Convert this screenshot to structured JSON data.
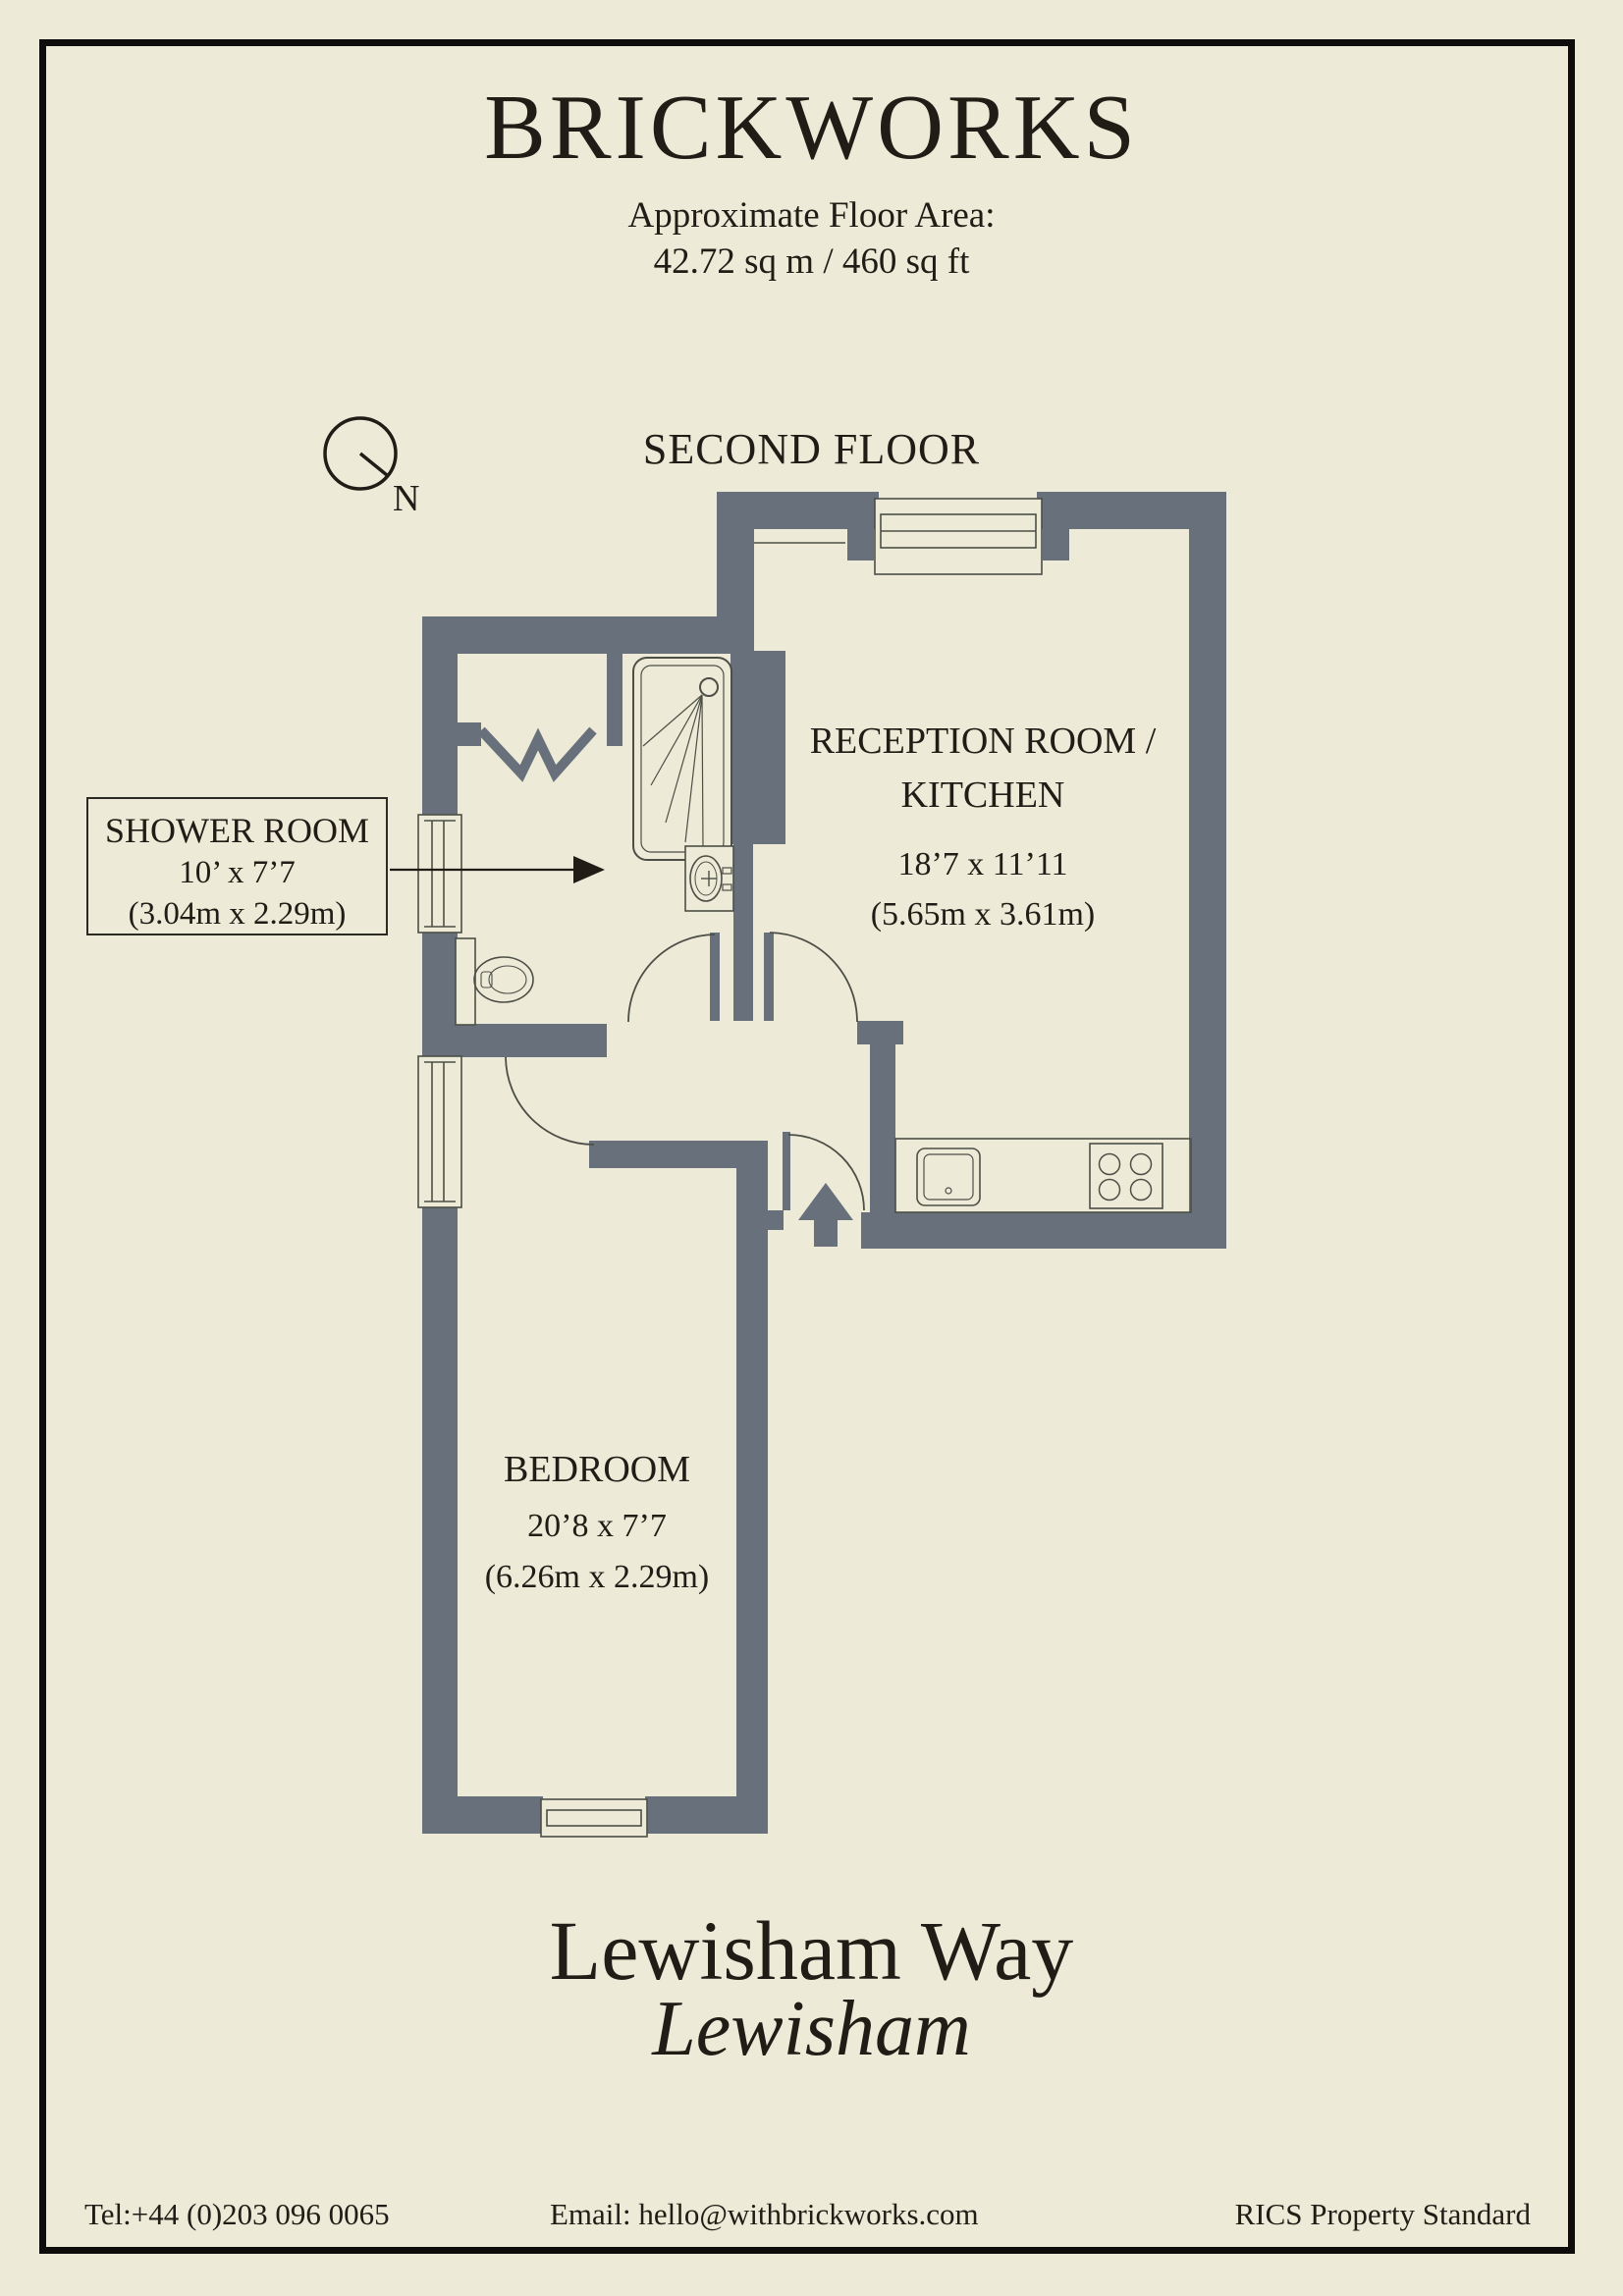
{
  "colors": {
    "background": "#EDEAD8",
    "wall": "#68717B",
    "line": "#4D4F46",
    "text": "#211C15"
  },
  "header": {
    "title": "BRICKWORKS",
    "floor_area_label": "Approximate Floor Area:",
    "floor_area_value": "42.72 sq m / 460 sq ft"
  },
  "plan": {
    "floor_label": "SECOND FLOOR",
    "compass_label": "N"
  },
  "rooms": {
    "reception": {
      "name_line1": "RECEPTION ROOM /",
      "name_line2": "KITCHEN",
      "dims_imperial": "18’7 x 11’11",
      "dims_metric": "(5.65m x 3.61m)"
    },
    "shower": {
      "name": "SHOWER ROOM",
      "dims_imperial": "10’ x 7’7",
      "dims_metric": "(3.04m x 2.29m)"
    },
    "bedroom": {
      "name": "BEDROOM",
      "dims_imperial": "20’8 x 7’7",
      "dims_metric": "(6.26m x 2.29m)"
    }
  },
  "address": {
    "line1": "Lewisham Way",
    "line2": "Lewisham"
  },
  "footer": {
    "tel": "Tel:+44 (0)203 096 0065",
    "email": "Email: hello@withbrickworks.com",
    "standard": "RICS Property Standard"
  }
}
